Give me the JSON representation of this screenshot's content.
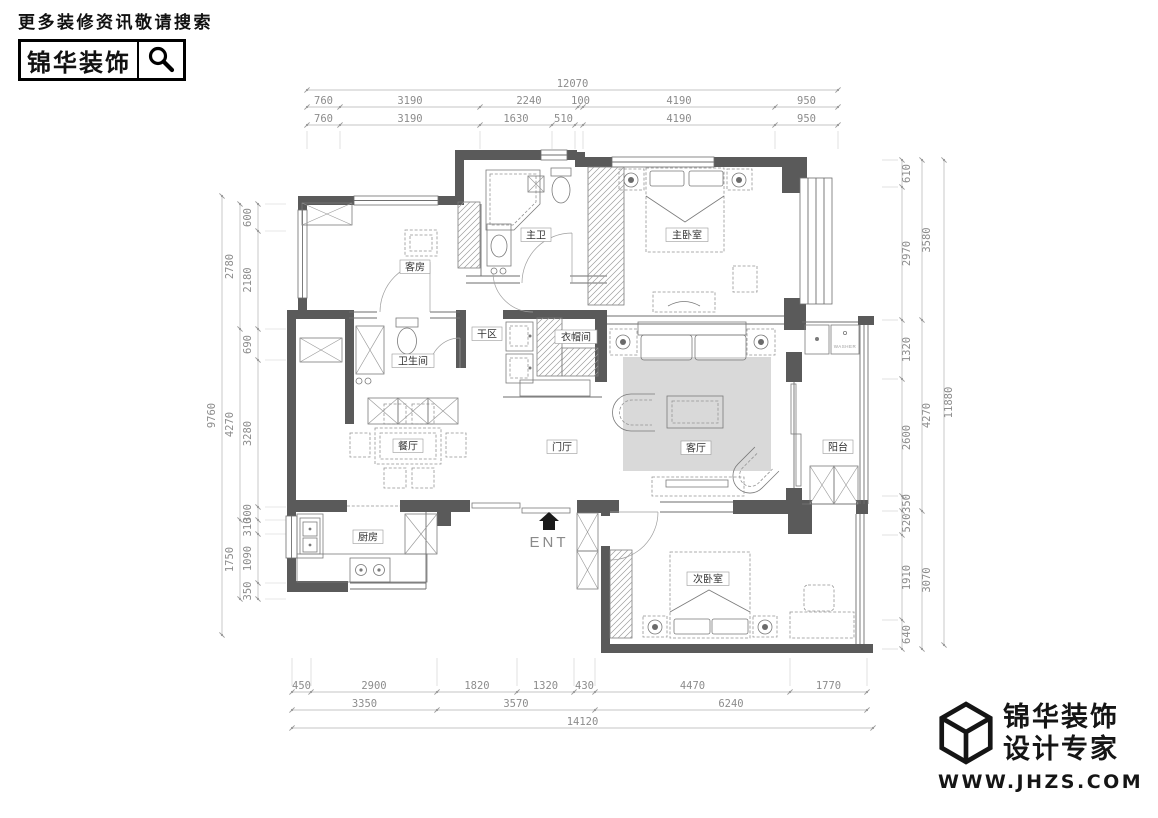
{
  "header": {
    "tagline": "更多装修资讯敬请搜索",
    "brand": "锦华装饰",
    "search_icon": "search-icon"
  },
  "footer": {
    "brand_line1": "锦华装饰",
    "brand_line2": "设计专家",
    "website": "WWW.JHZS.COM",
    "logo_icon": "cube-logo-icon"
  },
  "plan": {
    "rooms": [
      {
        "id": "guest-room",
        "label": "客房"
      },
      {
        "id": "master-bath",
        "label": "主卫"
      },
      {
        "id": "master-bedroom",
        "label": "主卧室"
      },
      {
        "id": "dry-area",
        "label": "干区"
      },
      {
        "id": "bathroom",
        "label": "卫生间"
      },
      {
        "id": "cloakroom",
        "label": "衣帽间"
      },
      {
        "id": "dining-room",
        "label": "餐厅"
      },
      {
        "id": "foyer",
        "label": "门厅"
      },
      {
        "id": "living-room",
        "label": "客厅"
      },
      {
        "id": "balcony",
        "label": "阳台"
      },
      {
        "id": "kitchen",
        "label": "厨房"
      },
      {
        "id": "second-bedroom",
        "label": "次卧室"
      }
    ],
    "entry_label": "ENT",
    "entry_icon": "entry-house-icon",
    "washer_label": "WASHER",
    "colors": {
      "wall": "#5a5a5a",
      "rug": "#d9d9d9",
      "dim_text": "#8c8c8c",
      "dim_line": "#b3b3b3"
    }
  },
  "dimensions": {
    "top": {
      "total": "12070",
      "row1": [
        "760",
        "3190",
        "2240",
        "100",
        "4190",
        "950"
      ],
      "row2": [
        "760",
        "3190",
        "1630",
        "510",
        "4190",
        "950"
      ]
    },
    "bottom": {
      "row1": [
        "450",
        "2900",
        "1820",
        "1320",
        "430",
        "4470",
        "1770"
      ],
      "row2": [
        "3350",
        "3570",
        "6240"
      ],
      "total": "14120"
    },
    "left": {
      "inner": [
        "600",
        "2180",
        "690",
        "3280",
        "300",
        "310",
        "1090",
        "350"
      ],
      "mid": [
        "2780",
        "4270",
        "1750"
      ],
      "total": "9760"
    },
    "right": {
      "inner": [
        "610",
        "2970",
        "1320",
        "2600",
        "350",
        "520",
        "1910",
        "640"
      ],
      "mid": [
        "3580",
        "4270",
        "3070"
      ],
      "total": "11880"
    }
  }
}
